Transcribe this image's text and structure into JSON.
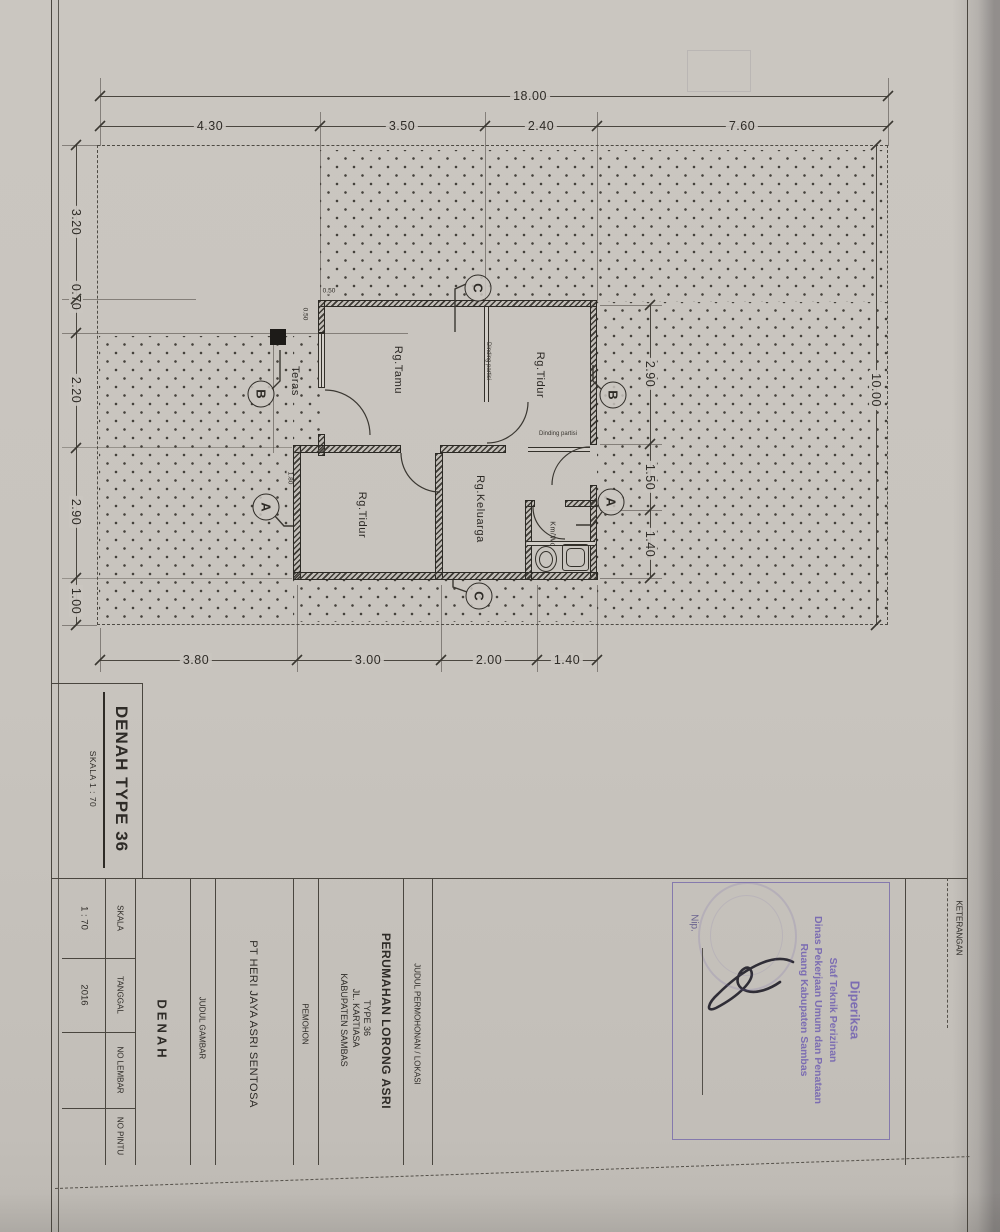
{
  "sheet": {
    "heading": {
      "title": "DENAH TYPE 36",
      "scale": "SKALA 1 : 70"
    },
    "plan": {
      "rooms": {
        "teras": "Teras",
        "tamu": "Rg.Tamu",
        "tidur_atas": "Rg.Tidur",
        "tidur_bawah": "Rg.Tidur",
        "keluarga": "Rg.Keluarga",
        "kmwc": "Km/Wc"
      },
      "wall_notes": {
        "partisi_vertikal": "Dinding partisi",
        "partisi_horizontal": "Dinding partisi"
      },
      "section_markers": {
        "a": "A",
        "b": "B",
        "c": "C"
      },
      "dims": {
        "top_total": "18.00",
        "top_segments": [
          "4.30",
          "3.50",
          "2.40",
          "7.60"
        ],
        "left": [
          "3.20",
          "0.70",
          "2.20",
          "2.90",
          "1.00"
        ],
        "right_total": "10.00",
        "right_inner": [
          "2.90",
          "1.50",
          "1.40"
        ],
        "bottom": [
          "3.80",
          "3.00",
          "2.00",
          "1.40"
        ],
        "detail": [
          "0.50",
          "0.50",
          "1.80"
        ]
      }
    },
    "title_block": {
      "skala_label": "SKALA",
      "skala_value": "1 : 70",
      "tanggal_label": "TANGGAL",
      "tanggal_value": "2016",
      "no_lembar_label": "NO LEMBAR",
      "no_pintu_label": "NO PINTU",
      "judul_gambar_label": "JUDUL GAMBAR",
      "judul_gambar_value": "DENAH",
      "pemohon_label": "PEMOHON",
      "pemohon_value": "PT  HERI JAYA ASRI SENTOSA",
      "judul_permohonan_label": "JUDUL PERMOHONAN / LOKASI",
      "lokasi": [
        "PERUMAHAN LORONG ASRI",
        "TYPE 36",
        "JL. KARTIASA",
        "KABUPATEN SAMBAS"
      ],
      "keterangan_label": "KETERANGAN"
    },
    "stamp": {
      "line1": "Diperiksa",
      "line2": "Staf Teknik Perizinan",
      "line3": "Dinas Pekerjaan Umum dan Penataan",
      "line4": "Ruang Kabupaten Sambas",
      "nip_label": "Nip."
    },
    "colors": {
      "stamp_purple": "#7b6cb2",
      "ink": "#3a3733",
      "paper": "#c9c5bf"
    }
  }
}
